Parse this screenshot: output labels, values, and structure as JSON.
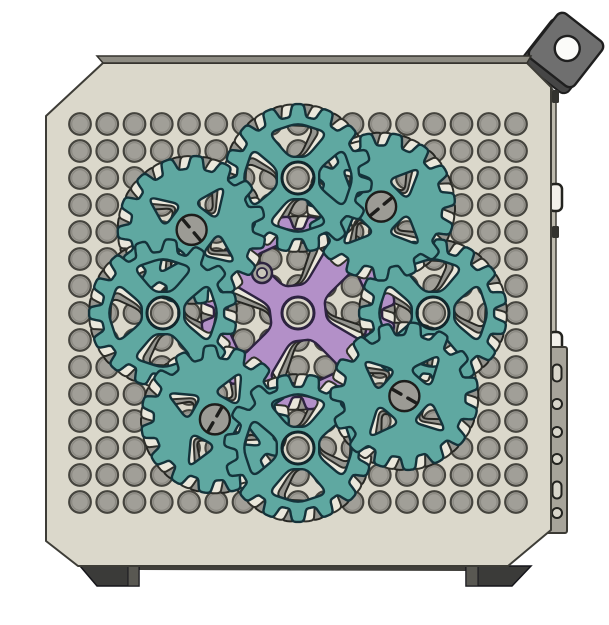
{
  "scene_label": "CAD render of perforated case side panel with planetary gear assembly",
  "canvas": {
    "w": 609,
    "h": 625,
    "background": "#ffffff"
  },
  "panel": {
    "face_color": "#dbd8cb",
    "rim_color": "#8e8c83",
    "side_color": "#bdbaae",
    "outline": "#3e3d37",
    "face_points": [
      [
        103,
        63
      ],
      [
        527,
        63
      ],
      [
        551,
        87
      ],
      [
        551,
        530
      ],
      [
        508,
        566
      ],
      [
        78,
        566
      ],
      [
        46,
        541
      ],
      [
        46,
        116
      ]
    ],
    "rim_points": [
      [
        97,
        56
      ],
      [
        531,
        56
      ],
      [
        527,
        63
      ],
      [
        103,
        63
      ]
    ],
    "side_points": [
      [
        551,
        87
      ],
      [
        556,
        95
      ],
      [
        556,
        525
      ],
      [
        551,
        530
      ]
    ]
  },
  "holes": {
    "x0": 80,
    "y0": 124,
    "pitch_x": 27.25,
    "pitch_y": 27.0,
    "cols": 17,
    "rows": 15,
    "r": 10.8,
    "fill": "#a19f98",
    "stroke": "#45443e",
    "inner_stroke": "#8d8b84"
  },
  "bracket": {
    "cx": 566,
    "cy": 50,
    "size": 57,
    "rotation": 38,
    "corner": 7,
    "hole_r": 12.5,
    "face": "#6f6f6f",
    "shadow": "#464646",
    "outline": "#1f1f1f",
    "hole_fill": "#fbfbf9",
    "shadow_offset": [
      -6,
      6
    ]
  },
  "right_edge": {
    "tabs": [
      [
        552,
        90,
        7,
        13
      ],
      [
        552,
        226,
        7,
        12
      ]
    ],
    "tab_fill": "#33332f",
    "handles": [
      [
        549,
        184,
        13,
        27
      ],
      [
        549,
        332,
        13,
        26
      ]
    ],
    "handle_fill": "#f2f0ea",
    "handle_stroke": "#23231f",
    "rail": {
      "x": 545,
      "y": 347,
      "w": 22,
      "h": 186,
      "fill": "#a7a49a",
      "stroke": "#3b3a34",
      "cx": 557,
      "circle_r": 5,
      "slot_w": 9,
      "slot_h": 17,
      "hole_fill": "#d8d5ca",
      "items": [
        {
          "type": "slot",
          "y": 373
        },
        {
          "type": "circle",
          "y": 404
        },
        {
          "type": "circle",
          "y": 432
        },
        {
          "type": "circle",
          "y": 459
        },
        {
          "type": "slot",
          "y": 490
        },
        {
          "type": "circle",
          "y": 513
        }
      ]
    }
  },
  "feet": {
    "fill": "#3b3b39",
    "stripe_fill": "#595852",
    "outline": "#15151a",
    "left": {
      "points": [
        [
          80,
          566
        ],
        [
          139,
          566
        ],
        [
          139,
          586
        ],
        [
          97,
          586
        ]
      ],
      "stripe": [
        128,
        566,
        11,
        20
      ]
    },
    "right": {
      "points": [
        [
          466,
          566
        ],
        [
          531,
          566
        ],
        [
          512,
          586
        ],
        [
          466,
          586
        ]
      ],
      "stripe": [
        466,
        566,
        12,
        20
      ]
    },
    "underside": [
      [
        139,
        566
      ],
      [
        466,
        566
      ],
      [
        466,
        571
      ],
      [
        139,
        570
      ]
    ],
    "underside_fill": "#403f3b"
  },
  "gears": {
    "center": [
      298,
      313
    ],
    "ring_radius": 135,
    "palette": {
      "teal": {
        "fill": "#5fa8a1",
        "stroke": "#14323a",
        "sw": 2.4
      },
      "cream": {
        "fill": "#eae7db",
        "stroke": "#30302b",
        "sw": 2.0
      },
      "gray": {
        "fill": "#95958f",
        "stroke": "#262622",
        "sw": 2.0
      },
      "purple": {
        "fill": "#b390c8",
        "stroke": "#2d2340",
        "sw": 2.4
      }
    },
    "sun": {
      "teeth": 20,
      "r_outer": 97,
      "r_root": 84,
      "rot": 4,
      "hub_r": 16,
      "cutouts": {
        "r1": 30,
        "r2": 72,
        "half_angle": 31,
        "angles": [
          7,
          97,
          187,
          277
        ]
      },
      "screw": {
        "x": 262,
        "y": 273,
        "r_outer": 10,
        "r_inner": 5,
        "fill": "#a3a19a",
        "inner_fill": "#c9c6ba"
      },
      "layer_rot": {
        "gray": 12,
        "cream": 6
      }
    },
    "planets": {
      "teeth": 15,
      "r_outer": 74,
      "r_root": 61,
      "hub_r": 16,
      "sector": {
        "r1": 23,
        "r2": 54,
        "half_angle": 33,
        "angles": [
          0,
          90,
          180,
          270
        ]
      },
      "triangle": {
        "dist": 36,
        "size": 19,
        "angles": [
          45,
          135,
          225,
          315
        ]
      },
      "screw_r": 15,
      "screw_fill": "#9c9b95",
      "screw_stroke": "#1d1d1b",
      "hub_ring_stroke": "#11262c",
      "layer_rot": {
        "gray": 16,
        "cream": 8
      },
      "items": [
        {
          "angle": 0,
          "style": "hub",
          "rot": 6
        },
        {
          "angle": 52,
          "style": "screw",
          "rot": 0,
          "slot": 40
        },
        {
          "angle": 90,
          "style": "hub",
          "rot": 12
        },
        {
          "angle": 142,
          "style": "screw",
          "rot": 8,
          "slot": 130
        },
        {
          "angle": 180,
          "style": "hub",
          "rot": 6
        },
        {
          "angle": 232,
          "style": "screw",
          "rot": 16,
          "slot": 60
        },
        {
          "angle": 270,
          "style": "hub",
          "rot": 0
        },
        {
          "angle": 322,
          "style": "screw",
          "rot": 4,
          "slot": 150
        }
      ]
    }
  }
}
